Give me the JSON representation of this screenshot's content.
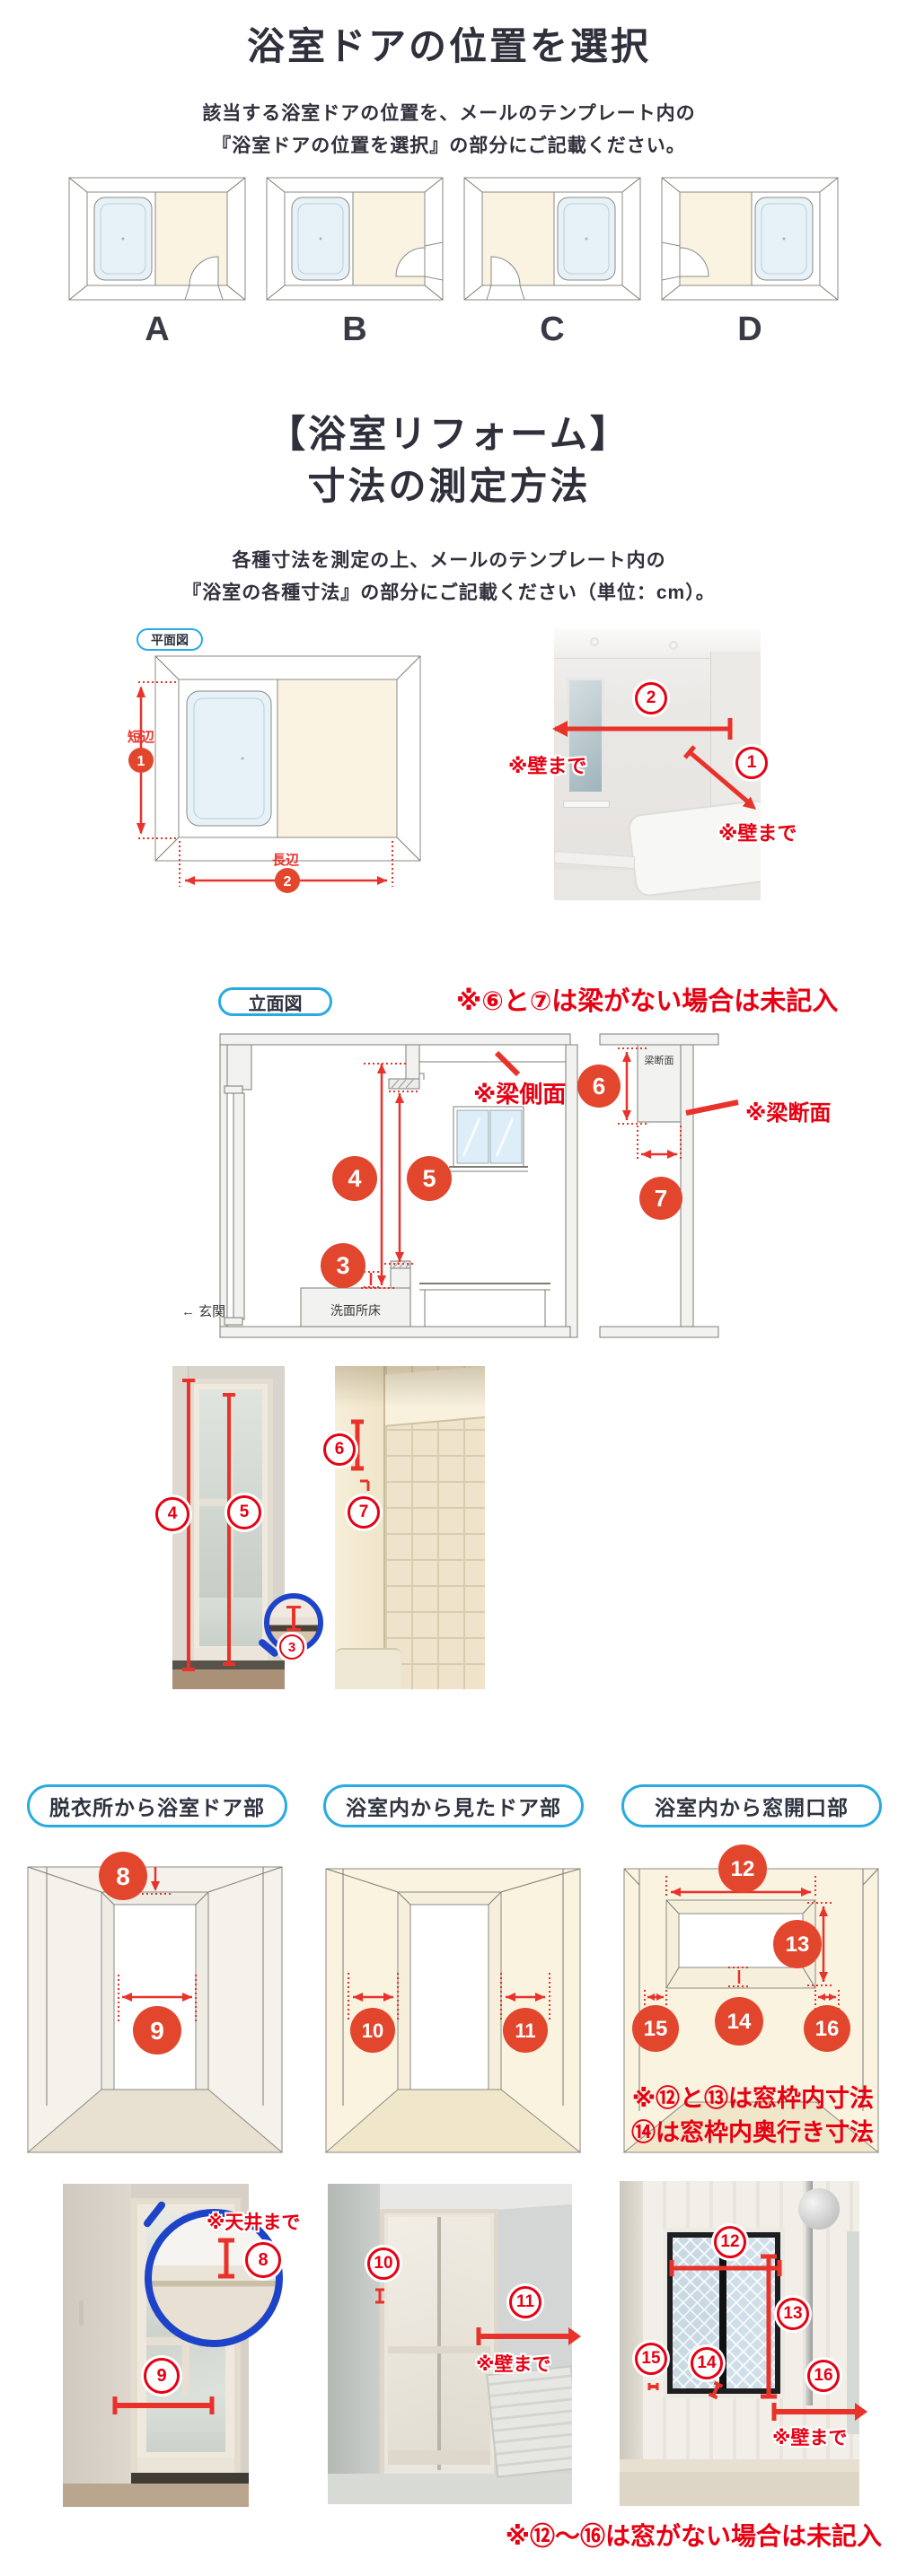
{
  "section1": {
    "title": "浴室ドアの位置を選択",
    "subtitle1": "該当する浴室ドアの位置を、メールのテンプレート内の",
    "subtitle2": "『浴室ドアの位置を選択』の部分にご記載ください。",
    "options": [
      {
        "label": "A"
      },
      {
        "label": "B"
      },
      {
        "label": "C"
      },
      {
        "label": "D"
      }
    ]
  },
  "section2": {
    "title1": "【浴室リフォーム】",
    "title2": "寸法の測定方法",
    "subtitle1": "各種寸法を測定の上、メールのテンプレート内の",
    "subtitle2": "『浴室の各種寸法』の部分にご記載ください（単位：cm）。"
  },
  "floorplan": {
    "badge": "平面図",
    "short_side": "短辺",
    "long_side": "長辺"
  },
  "elevation": {
    "badge": "立面図",
    "beam_note": "※⑥と⑦は梁がない場合は未記入",
    "beam_side_note": "※梁側面",
    "beam_section_small": "梁断面",
    "beam_section_note": "※梁断面",
    "washroom_floor": "洗面所床",
    "entrance": "← 玄関"
  },
  "photo_notes": {
    "wall1": "※壁まで",
    "wall2": "※壁まで",
    "wall3": "※壁まで",
    "wall4": "※壁まで",
    "ceiling": "※天井まで"
  },
  "bottom": {
    "header1": "脱衣所から浴室ドア部",
    "header2": "浴室内から見たドア部",
    "header3": "浴室内から窓開口部",
    "window_note1": "※⑫と⑬は窓枠内寸法",
    "window_note2": "⑭は窓枠内奥行き寸法",
    "final_note": "※⑫〜⑯は窓がない場合は未記入"
  },
  "markers": {
    "m1": "1",
    "m2": "2",
    "m3": "3",
    "m4": "4",
    "m5": "5",
    "m6": "6",
    "m7": "7",
    "m8": "8",
    "m9": "9",
    "m10": "10",
    "m11": "11",
    "m12": "12",
    "m13": "13",
    "m14": "14",
    "m15": "15",
    "m16": "16"
  },
  "colors": {
    "accent_blue": "#29abe2",
    "red": "#e60012",
    "marker_red": "#e2472e",
    "navy": "#30303c"
  }
}
